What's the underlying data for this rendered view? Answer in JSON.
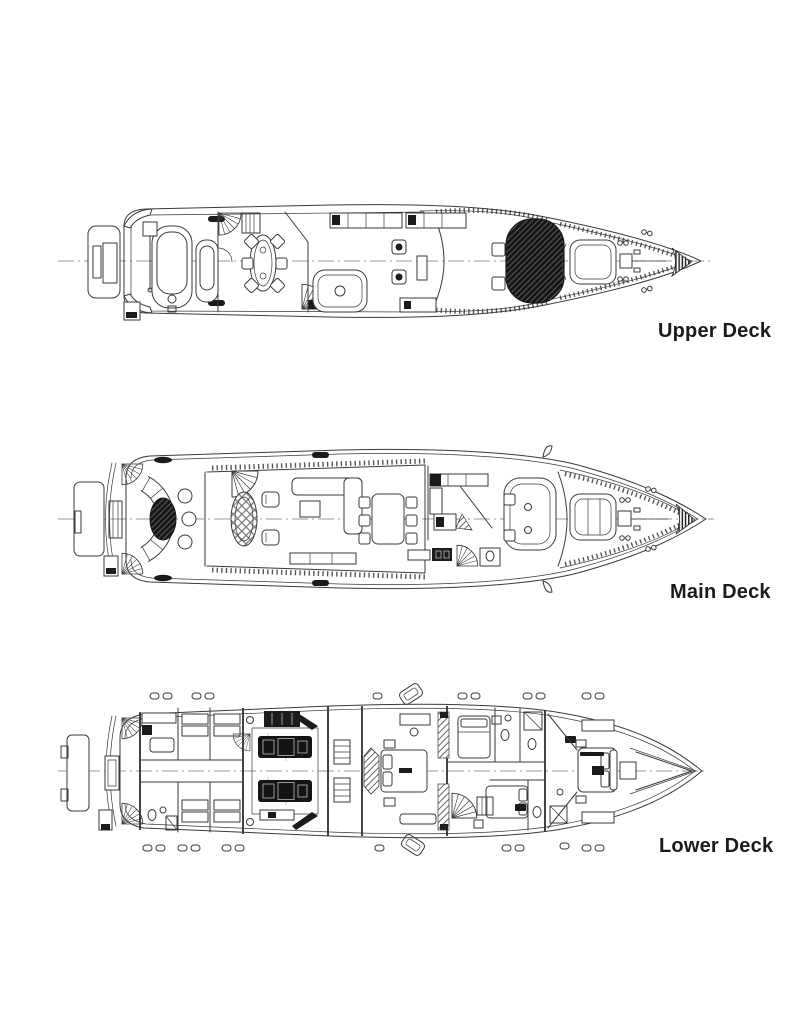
{
  "page": {
    "width": 800,
    "height": 1036,
    "background": "#ffffff"
  },
  "drawing": {
    "style": "technical-line-drawing",
    "line_color": "#3a3a3a",
    "dark_fill": "#1b1b1b",
    "centerline_color": "#9a9a9a",
    "orientation": "bow-right"
  },
  "decks": [
    {
      "id": "upper-deck",
      "label": "Upper Deck"
    },
    {
      "id": "main-deck",
      "label": "Main Deck"
    },
    {
      "id": "lower-deck",
      "label": "Lower Deck"
    }
  ]
}
